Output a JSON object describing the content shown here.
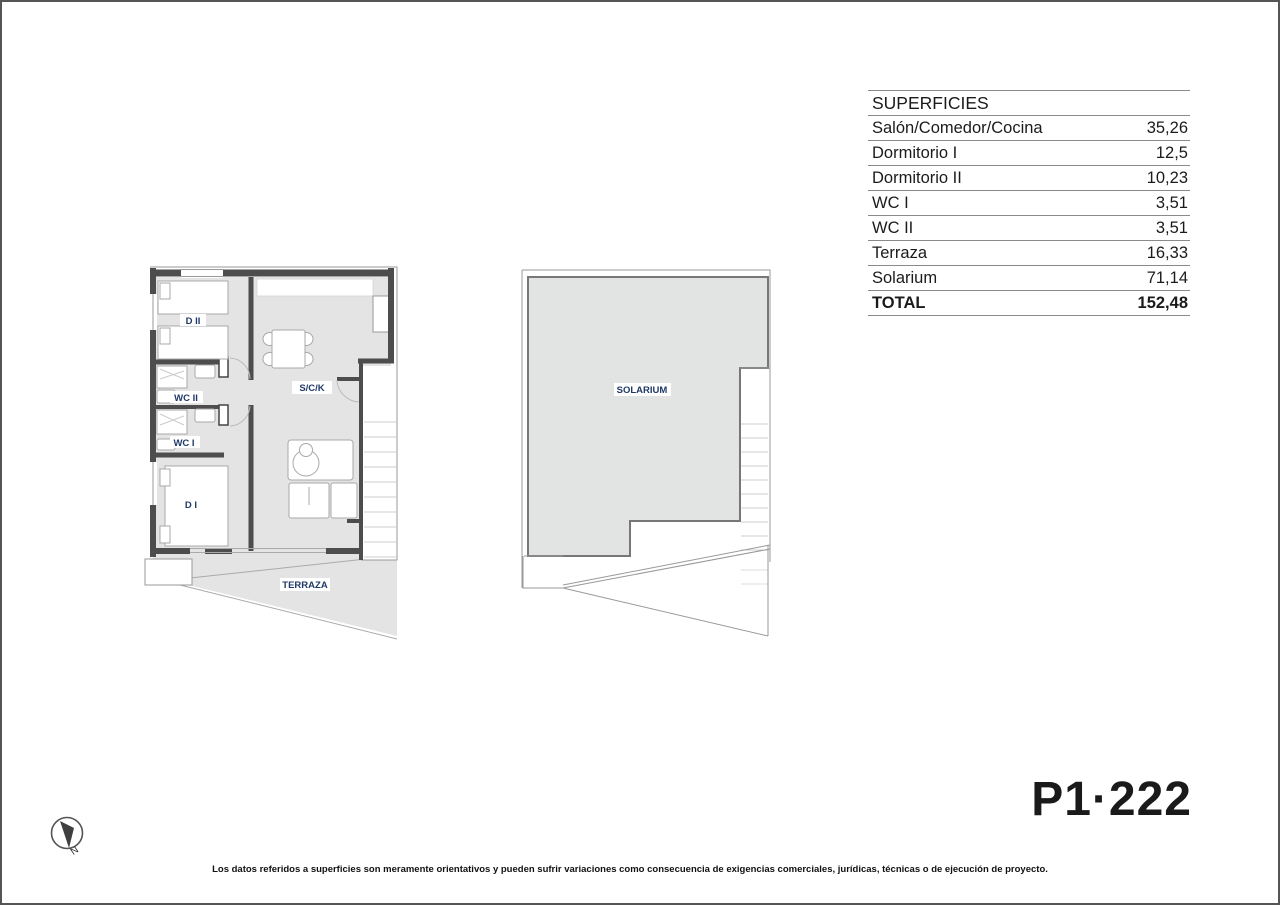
{
  "page": {
    "plan_code": "P1·222",
    "north_label": "N",
    "disclaimer": "Los datos referidos a superficies son meramente orientativos y pueden sufrir variaciones como consecuencia de exigencias comerciales, jurídicas, técnicas o de ejecución de proyecto."
  },
  "surfaces_table": {
    "title": "SUPERFICIES",
    "rows": [
      {
        "label": "Salón/Comedor/Cocina",
        "value": "35,26"
      },
      {
        "label": "Dormitorio I",
        "value": "12,5"
      },
      {
        "label": "Dormitorio II",
        "value": "10,23"
      },
      {
        "label": "WC I",
        "value": "3,51"
      },
      {
        "label": "WC II",
        "value": "3,51"
      },
      {
        "label": "Terraza",
        "value": "16,33"
      },
      {
        "label": "Solarium",
        "value": "71,14"
      }
    ],
    "total": {
      "label": "TOTAL",
      "value": "152,48"
    }
  },
  "floor_plan": {
    "room_labels": {
      "d2": "D II",
      "wc2": "WC II",
      "wc1": "WC I",
      "d1": "D I",
      "sck": "S/C/K",
      "terraza": "TERRAZA",
      "solarium": "SOLARIUM"
    }
  },
  "colors": {
    "room_fill": "#e4e4e4",
    "solarium_fill": "#e2e3e3",
    "wall": "#4d4d4d",
    "label_navy": "#1f3a68",
    "table_line": "#8a8a8a"
  }
}
